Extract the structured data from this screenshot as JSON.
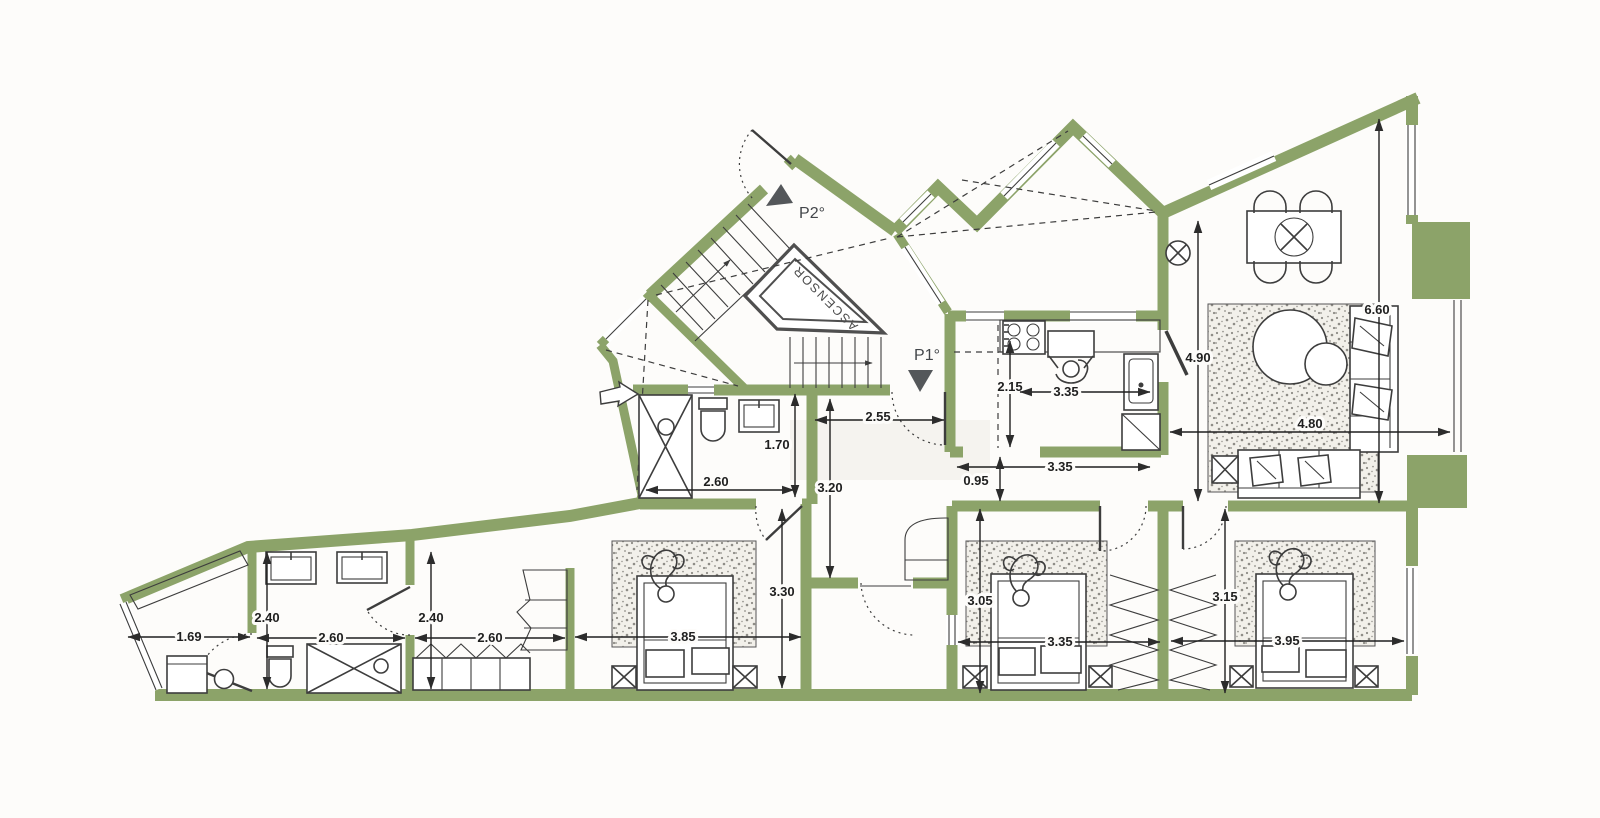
{
  "plan": {
    "labels": {
      "elevator": "ASCENSOR",
      "floor_marker_p2": "P2°",
      "floor_marker_p1": "P1°"
    },
    "dims": {
      "utility_width": "1.69",
      "bath_depth": "2.40",
      "bath_width": "2.60",
      "dressing_depth": "2.40",
      "dressing_width": "2.60",
      "bedroom1_width": "3.85",
      "bedroom1_depth": "3.30",
      "shower_room_width": "2.60",
      "shower_room_depth": "1.70",
      "hall_width": "2.55",
      "hall_depth": "3.20",
      "kitchen_depth": "2.15",
      "kitchen_width": "3.35",
      "kitchen_width_total": "3.35",
      "kitchen_pass_depth": "0.95",
      "kitchen_zone_depth": "4.90",
      "living_width": "4.80",
      "living_depth": "6.60",
      "bedroom2_depth": "3.05",
      "bedroom2_width": "3.35",
      "bedroom3_depth": "3.15",
      "bedroom3_width": "3.95"
    },
    "colors": {
      "wall": "#8ca369",
      "line": "#3d3d3d",
      "paper": "#fdfcfa",
      "elevator": "#4f4f4f",
      "dim": "#1f1f1f",
      "marker": "#54575a",
      "speckle": "#8e8c86"
    }
  }
}
